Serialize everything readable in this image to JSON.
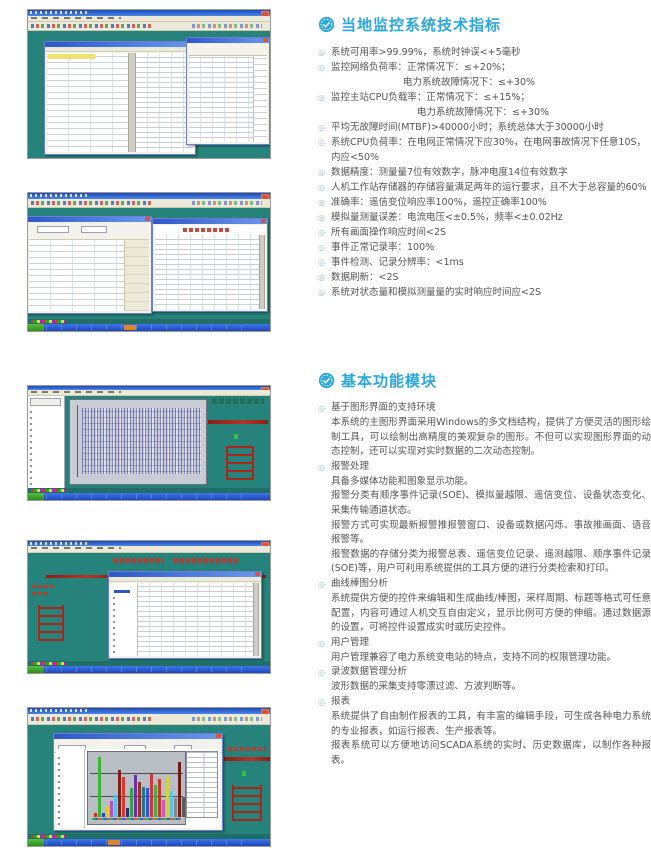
{
  "doc": {
    "colors": {
      "accent_blue": "#2AA7DF",
      "desktop_teal": "#26837B",
      "body_text_gray": "#555555",
      "diagram_red": "#A8261A"
    },
    "sections": {
      "specs": {
        "icon": "badge-check-icon",
        "title": "当地监控系统技术指标",
        "items": [
          {
            "bullet": true,
            "level": 0,
            "text": "系统可用率>99.99%，系统时钟误<+5毫秒"
          },
          {
            "bullet": true,
            "level": 0,
            "text": "监控网络负荷率：正常情况下：≤+20%；"
          },
          {
            "bullet": false,
            "level": 2,
            "text": "电力系统故障情况下：≤+30%"
          },
          {
            "bullet": true,
            "level": 0,
            "text": "监控主站CPU负载率：正常情况下：≤+15%；"
          },
          {
            "bullet": false,
            "level": 3,
            "text": "电力系统故障情况下：≤+30%"
          },
          {
            "bullet": true,
            "level": 0,
            "text": "平均无故障时间(MTBF)>40000小时；系统总体大于30000小时"
          },
          {
            "bullet": true,
            "level": 0,
            "text": "系统CPU负荷率：在电网正常情况下应30%，在电网事故情况下任意10S，"
          },
          {
            "bullet": false,
            "level": 1,
            "text": "内应<50%"
          },
          {
            "bullet": true,
            "level": 0,
            "text": "数据精度：测量量7位有效数字，脉冲电度14位有效数字"
          },
          {
            "bullet": true,
            "level": 0,
            "text": "人机工作站存储器的存储容量满足两年的运行要求，且不大于总容量的60%"
          },
          {
            "bullet": true,
            "level": 0,
            "text": "准确率：遥信变位响应率100%，遥控正确率100%"
          },
          {
            "bullet": true,
            "level": 0,
            "text": "模拟量测量误差：电流电压<±0.5%，频率<±0.02Hz"
          },
          {
            "bullet": true,
            "level": 0,
            "text": "所有画面操作响应时间<2S"
          },
          {
            "bullet": true,
            "level": 0,
            "text": "事件正常记录率：100%"
          },
          {
            "bullet": true,
            "level": 0,
            "text": "事件检测、记录分辨率：<1ms"
          },
          {
            "bullet": true,
            "level": 0,
            "text": "数据刷新：<2S"
          },
          {
            "bullet": true,
            "level": 0,
            "text": "系统对状态量和模拟测量量的实时响应时间应<2S"
          }
        ]
      },
      "features": {
        "icon": "badge-check-icon",
        "title": "基本功能模块",
        "items": [
          {
            "title": "基于图形界面的支持环境",
            "paragraphs": [
              "本系统的主图形界面采用Windows的多文档结构，提供了方便灵活的图形绘制工具，可以绘制出高精度的美观复杂的图形。不但可以实现图形界面的动态控制，还可以实现对实时数据的二次动态控制。"
            ]
          },
          {
            "title": "报警处理",
            "paragraphs": [
              "具备多媒体功能和图象显示功能。",
              "报警分类有顺序事件记录(SOE)、模拟量越限、遥信变位、设备状态变化、采集传输通道状态。",
              "报警方式可实现最新报警推报警窗口、设备或数据闪烁、事故推画面、语音报警等。",
              "报警数据的存储分类为报警总表、遥信变位记录、遥测越限、顺序事件记录(SOE)等，用户可利用系统提供的工具方便的进行分类检索和打印。"
            ]
          },
          {
            "title": "曲线棒图分析",
            "paragraphs": [
              "系统提供方便的控件来编辑和生成曲线/棒图，采样周期、标题等格式可任意配置，内容可通过人机交互自由定义，显示比例可方便的伸缩。通过数据源的设置，可将控件设置成实时或历史控件。"
            ]
          },
          {
            "title": "用户管理",
            "paragraphs": [
              "用户管理兼容了电力系统变电站的特点，支持不同的权限管理功能。"
            ]
          },
          {
            "title": "录波数据管理分析",
            "paragraphs": [
              "波形数据的采集支持零漂过滤、方波判断等。"
            ]
          },
          {
            "title": "报表",
            "paragraphs": [
              "系统提供了自由制作报表的工具，有丰富的编辑手段，可生成各种电力系统的专业报表，如运行报表、生产报表等。",
              "报表系统可以方便地访问SCADA系统的实时、历史数据库，以制作各种报表。"
            ]
          }
        ]
      }
    },
    "screenshots": {
      "count": 5,
      "bar_chart": {
        "type": "bar",
        "values": [
          6,
          96,
          7,
          18,
          26,
          36,
          76,
          64,
          14,
          46,
          68,
          56,
          48,
          47,
          70,
          52,
          62,
          28,
          66,
          42,
          30,
          88,
          33,
          20,
          40
        ],
        "colors": [
          "#d42a1e",
          "#35b435",
          "#2b3bd4",
          "#d8d22a",
          "#c04ac0",
          "#4ec4e8",
          "#7e1f1a",
          "#d43a30",
          "#23307e",
          "#37a04a",
          "#6e2fa0",
          "#93312a",
          "#1f7a86",
          "#3353c8",
          "#cc3440",
          "#43ad43",
          "#c8362a",
          "#c85ac8",
          "#d8d23a",
          "#5ac8ea",
          "#8a8a8a",
          "#701c16",
          "#5a5a5a",
          "#8a46ac",
          "#272e8e"
        ]
      }
    }
  }
}
